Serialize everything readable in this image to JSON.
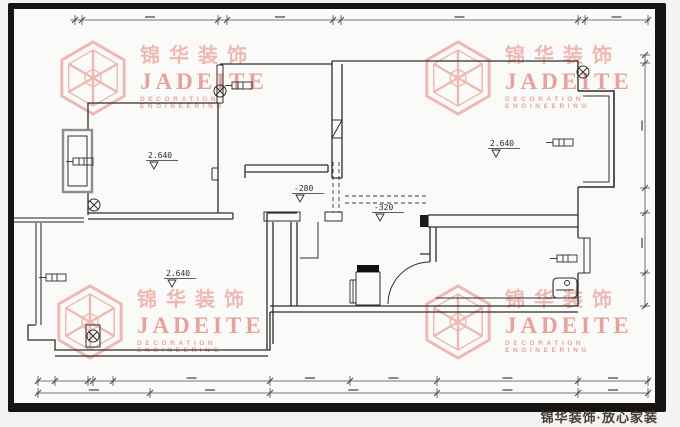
{
  "meta": {
    "width": 680,
    "height": 427
  },
  "colors": {
    "outside": "#f3f2f0",
    "paper": "#fafaf8",
    "frame": "#171513",
    "line": "#2d2d2d",
    "gray_wall": "#8d8d8d",
    "dim": "#4a4a4a",
    "dim_blob": "#8a8a8a",
    "watermark_pink": "#ecaaa5",
    "watermark_deep": "#e58f8a",
    "footer_text": "#453c35"
  },
  "watermark": {
    "chinese": "锦华装饰",
    "latin": "JADEITE",
    "sub_line1": "DECORATION",
    "sub_line2": "ENGINEERING"
  },
  "footer": {
    "brand": "锦华装饰·放心家装"
  },
  "plan": {
    "level_labels": [
      {
        "text": "2.640",
        "x": 148,
        "y": 158
      },
      {
        "text": "2.640",
        "x": 490,
        "y": 146
      },
      {
        "text": "2.640",
        "x": 166,
        "y": 276
      },
      {
        "text": "-280",
        "x": 294,
        "y": 191
      },
      {
        "text": "-320",
        "x": 374,
        "y": 210
      }
    ]
  },
  "dimensions": {
    "top": {
      "orientation": "h",
      "y": 20,
      "x1": 70,
      "x2": 650,
      "ticks": [
        75,
        82,
        218,
        227,
        333,
        341,
        578,
        585,
        648
      ]
    },
    "bottom_upper": {
      "orientation": "h",
      "y": 381,
      "x1": 36,
      "x2": 650,
      "ticks": [
        38,
        55,
        88,
        93,
        113,
        270,
        350,
        437,
        578,
        648
      ]
    },
    "bottom_lower": {
      "orientation": "h",
      "y": 393,
      "x1": 36,
      "x2": 650,
      "ticks": [
        38,
        150,
        270,
        437,
        578,
        648
      ]
    },
    "right": {
      "orientation": "v",
      "x": 645,
      "y1": 55,
      "y2": 308,
      "ticks": [
        55,
        63,
        188,
        213,
        273,
        306
      ]
    }
  }
}
